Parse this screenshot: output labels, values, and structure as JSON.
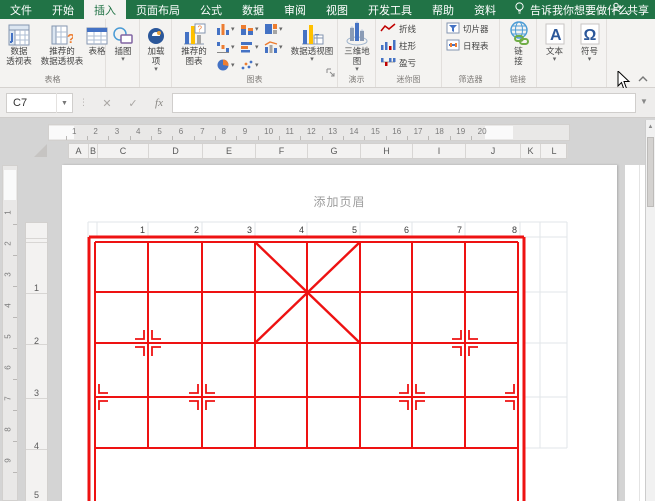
{
  "colors": {
    "green": "#217346",
    "red": "#ee1212",
    "blue": "#2b579a",
    "chart_blue": "#4472c4",
    "chart_orange": "#ed7d31",
    "chart_yellow": "#ffc000",
    "link_green": "#70ad47",
    "grid_gray": "#e2e5e8"
  },
  "tab_bar": {
    "tabs": [
      {
        "label": "文件",
        "active": false
      },
      {
        "label": "开始",
        "active": false
      },
      {
        "label": "插入",
        "active": true
      },
      {
        "label": "页面布局",
        "active": false
      },
      {
        "label": "公式",
        "active": false
      },
      {
        "label": "数据",
        "active": false
      },
      {
        "label": "审阅",
        "active": false
      },
      {
        "label": "视图",
        "active": false
      },
      {
        "label": "开发工具",
        "active": false
      },
      {
        "label": "帮助",
        "active": false
      },
      {
        "label": "资料",
        "active": false
      }
    ],
    "tell_me": {
      "icon": "lightbulb-icon",
      "label": "告诉我你想要做什么"
    },
    "share": {
      "icon": "person-icon",
      "label": "共享"
    }
  },
  "ribbon": {
    "groups": [
      {
        "label": "表格",
        "x": 0,
        "w": 106,
        "buttons": [
          {
            "name": "pivottable",
            "icon": "pivottable-icon",
            "lines": [
              "数据",
              "透视表"
            ],
            "x": 2,
            "w": 34
          },
          {
            "name": "recommended-pivottables",
            "icon": "recommended-pivottable-icon",
            "lines": [
              "推荐的",
              "数据透视表"
            ],
            "x": 36,
            "w": 52
          },
          {
            "name": "table",
            "icon": "table-icon",
            "lines": [
              "表格"
            ],
            "x": 88,
            "w": 18
          }
        ]
      },
      {
        "label": "",
        "x": 106,
        "w": 34,
        "buttons": [
          {
            "name": "illustrations",
            "icon": "shapes-icon",
            "lines": [
              "插图"
            ],
            "dropdown": true,
            "x": 2,
            "w": 30
          }
        ]
      },
      {
        "label": "",
        "x": 140,
        "w": 32,
        "buttons": [
          {
            "name": "add-ins",
            "icon": "addin-icon",
            "lines": [
              "加载",
              "项"
            ],
            "dropdown": true,
            "x": 2,
            "w": 28
          }
        ]
      },
      {
        "label": "图表",
        "x": 172,
        "w": 166,
        "dialog_launcher": true,
        "buttons": [
          {
            "name": "recommended-charts",
            "icon": "recommended-chart-icon",
            "lines": [
              "推荐的",
              "图表"
            ],
            "x": 2,
            "w": 40
          },
          {
            "name": "pivotchart",
            "icon": "pivotchart-icon",
            "lines": [
              "数据透视图"
            ],
            "dropdown": true,
            "x": 116,
            "w": 48
          }
        ],
        "mini_grid": {
          "x": 44,
          "y": 2,
          "cols": 3,
          "cell_w": 24,
          "cell_h": 18,
          "items": [
            {
              "name": "insert-column-chart",
              "icon": "mini-column-icon"
            },
            {
              "name": "insert-hierarchy-chart",
              "icon": "mini-stacked-icon"
            },
            {
              "name": "insert-waterfall-chart",
              "icon": "mini-hierarchy-icon"
            },
            {
              "name": "insert-line-chart",
              "icon": "mini-waterfall-icon"
            },
            {
              "name": "insert-bar-chart",
              "icon": "mini-bar-icon"
            },
            {
              "name": "insert-combo-chart",
              "icon": "mini-combo-icon"
            },
            {
              "name": "insert-pie-chart",
              "icon": "mini-pie-icon"
            },
            {
              "name": "insert-scatter-chart",
              "icon": "mini-scatter-icon"
            }
          ]
        }
      },
      {
        "label": "演示",
        "x": 338,
        "w": 38,
        "buttons": [
          {
            "name": "3d-map",
            "icon": "map3d-icon",
            "lines": [
              "三维地",
              "图"
            ],
            "dropdown": true,
            "x": 2,
            "w": 34
          }
        ]
      },
      {
        "label": "迷你图",
        "x": 376,
        "w": 66,
        "rows": [
          {
            "name": "sparkline-line",
            "icon": "sparkline-line-icon",
            "label": "折线"
          },
          {
            "name": "sparkline-column",
            "icon": "sparkline-column-icon",
            "label": "柱形"
          },
          {
            "name": "sparkline-winloss",
            "icon": "sparkline-winloss-icon",
            "label": "盈亏"
          }
        ]
      },
      {
        "label": "筛选器",
        "x": 442,
        "w": 58,
        "rows": [
          {
            "name": "slicer",
            "icon": "slicer-icon",
            "label": "切片器"
          },
          {
            "name": "timeline",
            "icon": "timeline-icon",
            "label": "日程表"
          }
        ]
      },
      {
        "label": "链接",
        "x": 500,
        "w": 37,
        "buttons": [
          {
            "name": "link",
            "icon": "link-icon",
            "lines": [
              "链",
              "接"
            ],
            "x": 2,
            "w": 33
          }
        ]
      },
      {
        "label": "",
        "x": 537,
        "w": 35,
        "buttons": [
          {
            "name": "text",
            "icon": "textbox-icon",
            "lines": [
              "文本"
            ],
            "dropdown": true,
            "x": 2,
            "w": 31
          }
        ]
      },
      {
        "label": "",
        "x": 572,
        "w": 35,
        "buttons": [
          {
            "name": "symbols",
            "icon": "omega-icon",
            "lines": [
              "符号"
            ],
            "dropdown": true,
            "x": 2,
            "w": 31
          }
        ]
      }
    ]
  },
  "formula_bar": {
    "name_box": "C7",
    "cancel": "✕",
    "enter": "✓",
    "fx": "fx",
    "formula": "",
    "dots": "⋮"
  },
  "worksheet": {
    "ruler_h_numbers": [
      1,
      2,
      3,
      4,
      5,
      6,
      7,
      8,
      9,
      10,
      11,
      12,
      13,
      14,
      15,
      16,
      17,
      18,
      19,
      20
    ],
    "ruler_v_numbers": [
      1,
      2,
      3,
      4,
      5,
      6,
      7,
      8,
      9
    ],
    "columns": [
      "A",
      "B",
      "C",
      "D",
      "E",
      "F",
      "G",
      "H",
      "I",
      "J",
      "K",
      "L"
    ],
    "col_edges": [
      68,
      88,
      97,
      148,
      202,
      255,
      307,
      360,
      412,
      465,
      520,
      540,
      567
    ],
    "row_headers": [
      "1",
      "2",
      "3",
      "4",
      "5"
    ],
    "row_header_y": [
      287,
      340,
      392,
      445,
      494
    ],
    "row_divider_y": [
      237,
      241,
      292,
      343,
      397,
      448
    ],
    "header_placeholder": "添加页眉",
    "cell_values": [
      "1",
      "2",
      "3",
      "4",
      "5",
      "6",
      "7",
      "8"
    ],
    "value_right_x": [
      83,
      137,
      190,
      242,
      295,
      347,
      400,
      455
    ],
    "value_y": 68
  },
  "board": {
    "frame": {
      "x1": 27,
      "y1": 72,
      "x2": 462,
      "y2": 336
    },
    "files_x": [
      33,
      86,
      140,
      193,
      245,
      298,
      350,
      403,
      456
    ],
    "ranks_y": [
      77,
      127,
      178,
      232,
      283
    ],
    "river_top": 283,
    "palace": {
      "x1": 193,
      "y1": 77,
      "x2": 298,
      "y2": 178
    },
    "markers": [
      {
        "x": 86,
        "y": 178,
        "sides": "both"
      },
      {
        "x": 403,
        "y": 178,
        "sides": "both"
      },
      {
        "x": 33,
        "y": 232,
        "sides": "right"
      },
      {
        "x": 140,
        "y": 232,
        "sides": "both"
      },
      {
        "x": 350,
        "y": 232,
        "sides": "both"
      },
      {
        "x": 456,
        "y": 232,
        "sides": "left"
      }
    ],
    "gray": {
      "row_top": 57,
      "row_bottom": 72,
      "cols": [
        26,
        35,
        86,
        140,
        193,
        245,
        298,
        350,
        403,
        458,
        478,
        505
      ],
      "right_cols": [
        478,
        505
      ],
      "right_rows": [
        127,
        178,
        232,
        283
      ],
      "right_x2": 505
    }
  }
}
